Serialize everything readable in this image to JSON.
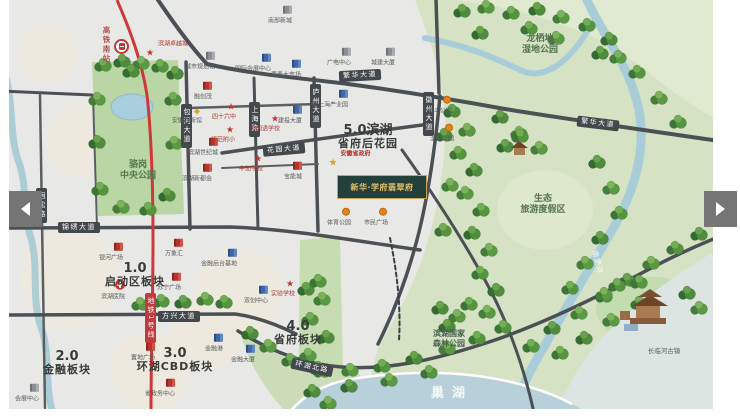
{
  "icons": {
    "prev": "left-arrow",
    "next": "right-arrow",
    "train": "train-station",
    "hospital": "red-cross"
  },
  "colors": {
    "metro_line": "#cf3838",
    "road": "#4b5054",
    "parkland": "#d5e2c4",
    "water": "#b7d0d9",
    "pill_bg": "#43484c",
    "plate_bg": "#24403a",
    "plate_text": "#e6c06a",
    "poi_red": "#b5342c",
    "poi_blue": "#3e66a8"
  },
  "project_plate": {
    "text": "新华·学府翡翠府"
  },
  "metro": {
    "station_text": "高铁南站",
    "line_badge": "地铁1号线"
  },
  "zones": [
    {
      "num": "1.0",
      "name": "启动区板块",
      "x": 135,
      "y": 262
    },
    {
      "num": "2.0",
      "name": "金融板块",
      "x": 67,
      "y": 350
    },
    {
      "num": "3.0",
      "name": "环湖CBD板块",
      "x": 175,
      "y": 347
    },
    {
      "num": "4.0",
      "name": "省府板块",
      "x": 298,
      "y": 320
    },
    {
      "num": "5.0滨湖",
      "name": "省府后花园",
      "x": 368,
      "y": 124
    }
  ],
  "road_labels": [
    {
      "text": "繁华大道",
      "x": 339,
      "y": 70,
      "rot": -3
    },
    {
      "text": "繁华大道",
      "x": 577,
      "y": 118,
      "rot": 7
    },
    {
      "text": "花园大道",
      "x": 263,
      "y": 144,
      "rot": -5
    },
    {
      "text": "锦绣大道",
      "x": 58,
      "y": 222,
      "rot": 0
    },
    {
      "text": "方兴大道",
      "x": 158,
      "y": 311,
      "rot": 0
    },
    {
      "text": "环湖北路",
      "x": 291,
      "y": 362,
      "rot": 12
    },
    {
      "text": "包河大道",
      "x": 181,
      "y": 104,
      "v": true
    },
    {
      "text": "上海路",
      "x": 249,
      "y": 102,
      "v": true
    },
    {
      "text": "庐州大道",
      "x": 310,
      "y": 84,
      "v": true
    },
    {
      "text": "徽州大道",
      "x": 423,
      "y": 92,
      "v": true
    },
    {
      "text": "宿松路",
      "x": 36,
      "y": 188,
      "v": true
    },
    {
      "text": "地铁1号线",
      "x": 145,
      "y": 293,
      "v": true,
      "red": true
    }
  ],
  "areas": [
    {
      "line1": "骆岗",
      "line2": "中央公园",
      "x": 138,
      "y": 160,
      "cls": "park"
    },
    {
      "line1": "龙栖地",
      "line2": "湿地公园",
      "x": 540,
      "y": 34,
      "cls": "park"
    },
    {
      "line1": "生态",
      "line2": "旅游度假区",
      "x": 543,
      "y": 194,
      "cls": "park"
    },
    {
      "line1": "滨湖国家",
      "line2": "森林公园",
      "x": 449,
      "y": 329,
      "cls": "forest"
    },
    {
      "line1": "长临河古镇",
      "line2": "",
      "x": 664,
      "y": 348,
      "cls": "town"
    },
    {
      "line1": "南淝河",
      "line2": "",
      "x": 597,
      "y": 258,
      "cls": "river",
      "rot": 75
    },
    {
      "line1": "巢湖",
      "line2": "",
      "x": 452,
      "y": 386,
      "cls": "lake"
    }
  ],
  "pois": [
    {
      "t": "滨湖卓越城",
      "x": 150,
      "y": 50,
      "k": "star",
      "lp": "r"
    },
    {
      "t": "城市规划馆",
      "x": 210,
      "y": 58,
      "k": "gray"
    },
    {
      "t": "国际会展中心",
      "x": 266,
      "y": 60,
      "k": "blue"
    },
    {
      "t": "要素大市场",
      "x": 296,
      "y": 66,
      "k": "blue"
    },
    {
      "t": "广电中心",
      "x": 346,
      "y": 54,
      "k": "gray"
    },
    {
      "t": "城建大厦",
      "x": 390,
      "y": 54,
      "k": "gray"
    },
    {
      "t": "南部新城",
      "x": 287,
      "y": 12,
      "k": "gray"
    },
    {
      "t": "融创茂",
      "x": 207,
      "y": 88,
      "k": "red"
    },
    {
      "t": "安徽创新馆",
      "x": 197,
      "y": 112,
      "k": "gold"
    },
    {
      "t": "滨湖世纪城",
      "x": 213,
      "y": 144,
      "k": "red"
    },
    {
      "t": "滨湖新都会",
      "x": 207,
      "y": 170,
      "k": "red"
    },
    {
      "t": "四十六中",
      "x": 231,
      "y": 108,
      "k": "star"
    },
    {
      "t": "师范附小",
      "x": 230,
      "y": 131,
      "k": "star"
    },
    {
      "t": "外国语学校",
      "x": 275,
      "y": 120,
      "k": "star"
    },
    {
      "t": "建投大厦",
      "x": 297,
      "y": 112,
      "k": "blue"
    },
    {
      "t": "新上海产业园",
      "x": 343,
      "y": 96,
      "k": "blue"
    },
    {
      "t": "金斗公园",
      "x": 447,
      "y": 102,
      "k": "orange"
    },
    {
      "t": "湿地公园",
      "x": 449,
      "y": 130,
      "k": "orange"
    },
    {
      "t": "中加学校",
      "x": 258,
      "y": 160,
      "k": "star"
    },
    {
      "t": "宝能城",
      "x": 297,
      "y": 168,
      "k": "red"
    },
    {
      "t": "安徽省政府",
      "x": 333,
      "y": 160,
      "k": "goldstar",
      "lp": "r"
    },
    {
      "t": "体育公园",
      "x": 346,
      "y": 214,
      "k": "orange"
    },
    {
      "t": "市民广场",
      "x": 383,
      "y": 214,
      "k": "orange"
    },
    {
      "t": "银河广场",
      "x": 118,
      "y": 249,
      "k": "red"
    },
    {
      "t": "万象汇",
      "x": 178,
      "y": 245,
      "k": "red"
    },
    {
      "t": "滨湖医院",
      "x": 120,
      "y": 288,
      "k": "cross"
    },
    {
      "t": "苏宁广场",
      "x": 176,
      "y": 279,
      "k": "red"
    },
    {
      "t": "金融后台基地",
      "x": 232,
      "y": 255,
      "k": "blue"
    },
    {
      "t": "双创中心",
      "x": 263,
      "y": 292,
      "k": "blue"
    },
    {
      "t": "实验学校",
      "x": 290,
      "y": 285,
      "k": "star"
    },
    {
      "t": "金融港",
      "x": 218,
      "y": 340,
      "k": "blue"
    },
    {
      "t": "金融大厦",
      "x": 250,
      "y": 351,
      "k": "blue"
    },
    {
      "t": "置地广场",
      "x": 150,
      "y": 349,
      "k": "red"
    },
    {
      "t": "省政务中心",
      "x": 170,
      "y": 385,
      "k": "red"
    },
    {
      "t": "会展中心",
      "x": 34,
      "y": 390,
      "k": "gray"
    }
  ]
}
